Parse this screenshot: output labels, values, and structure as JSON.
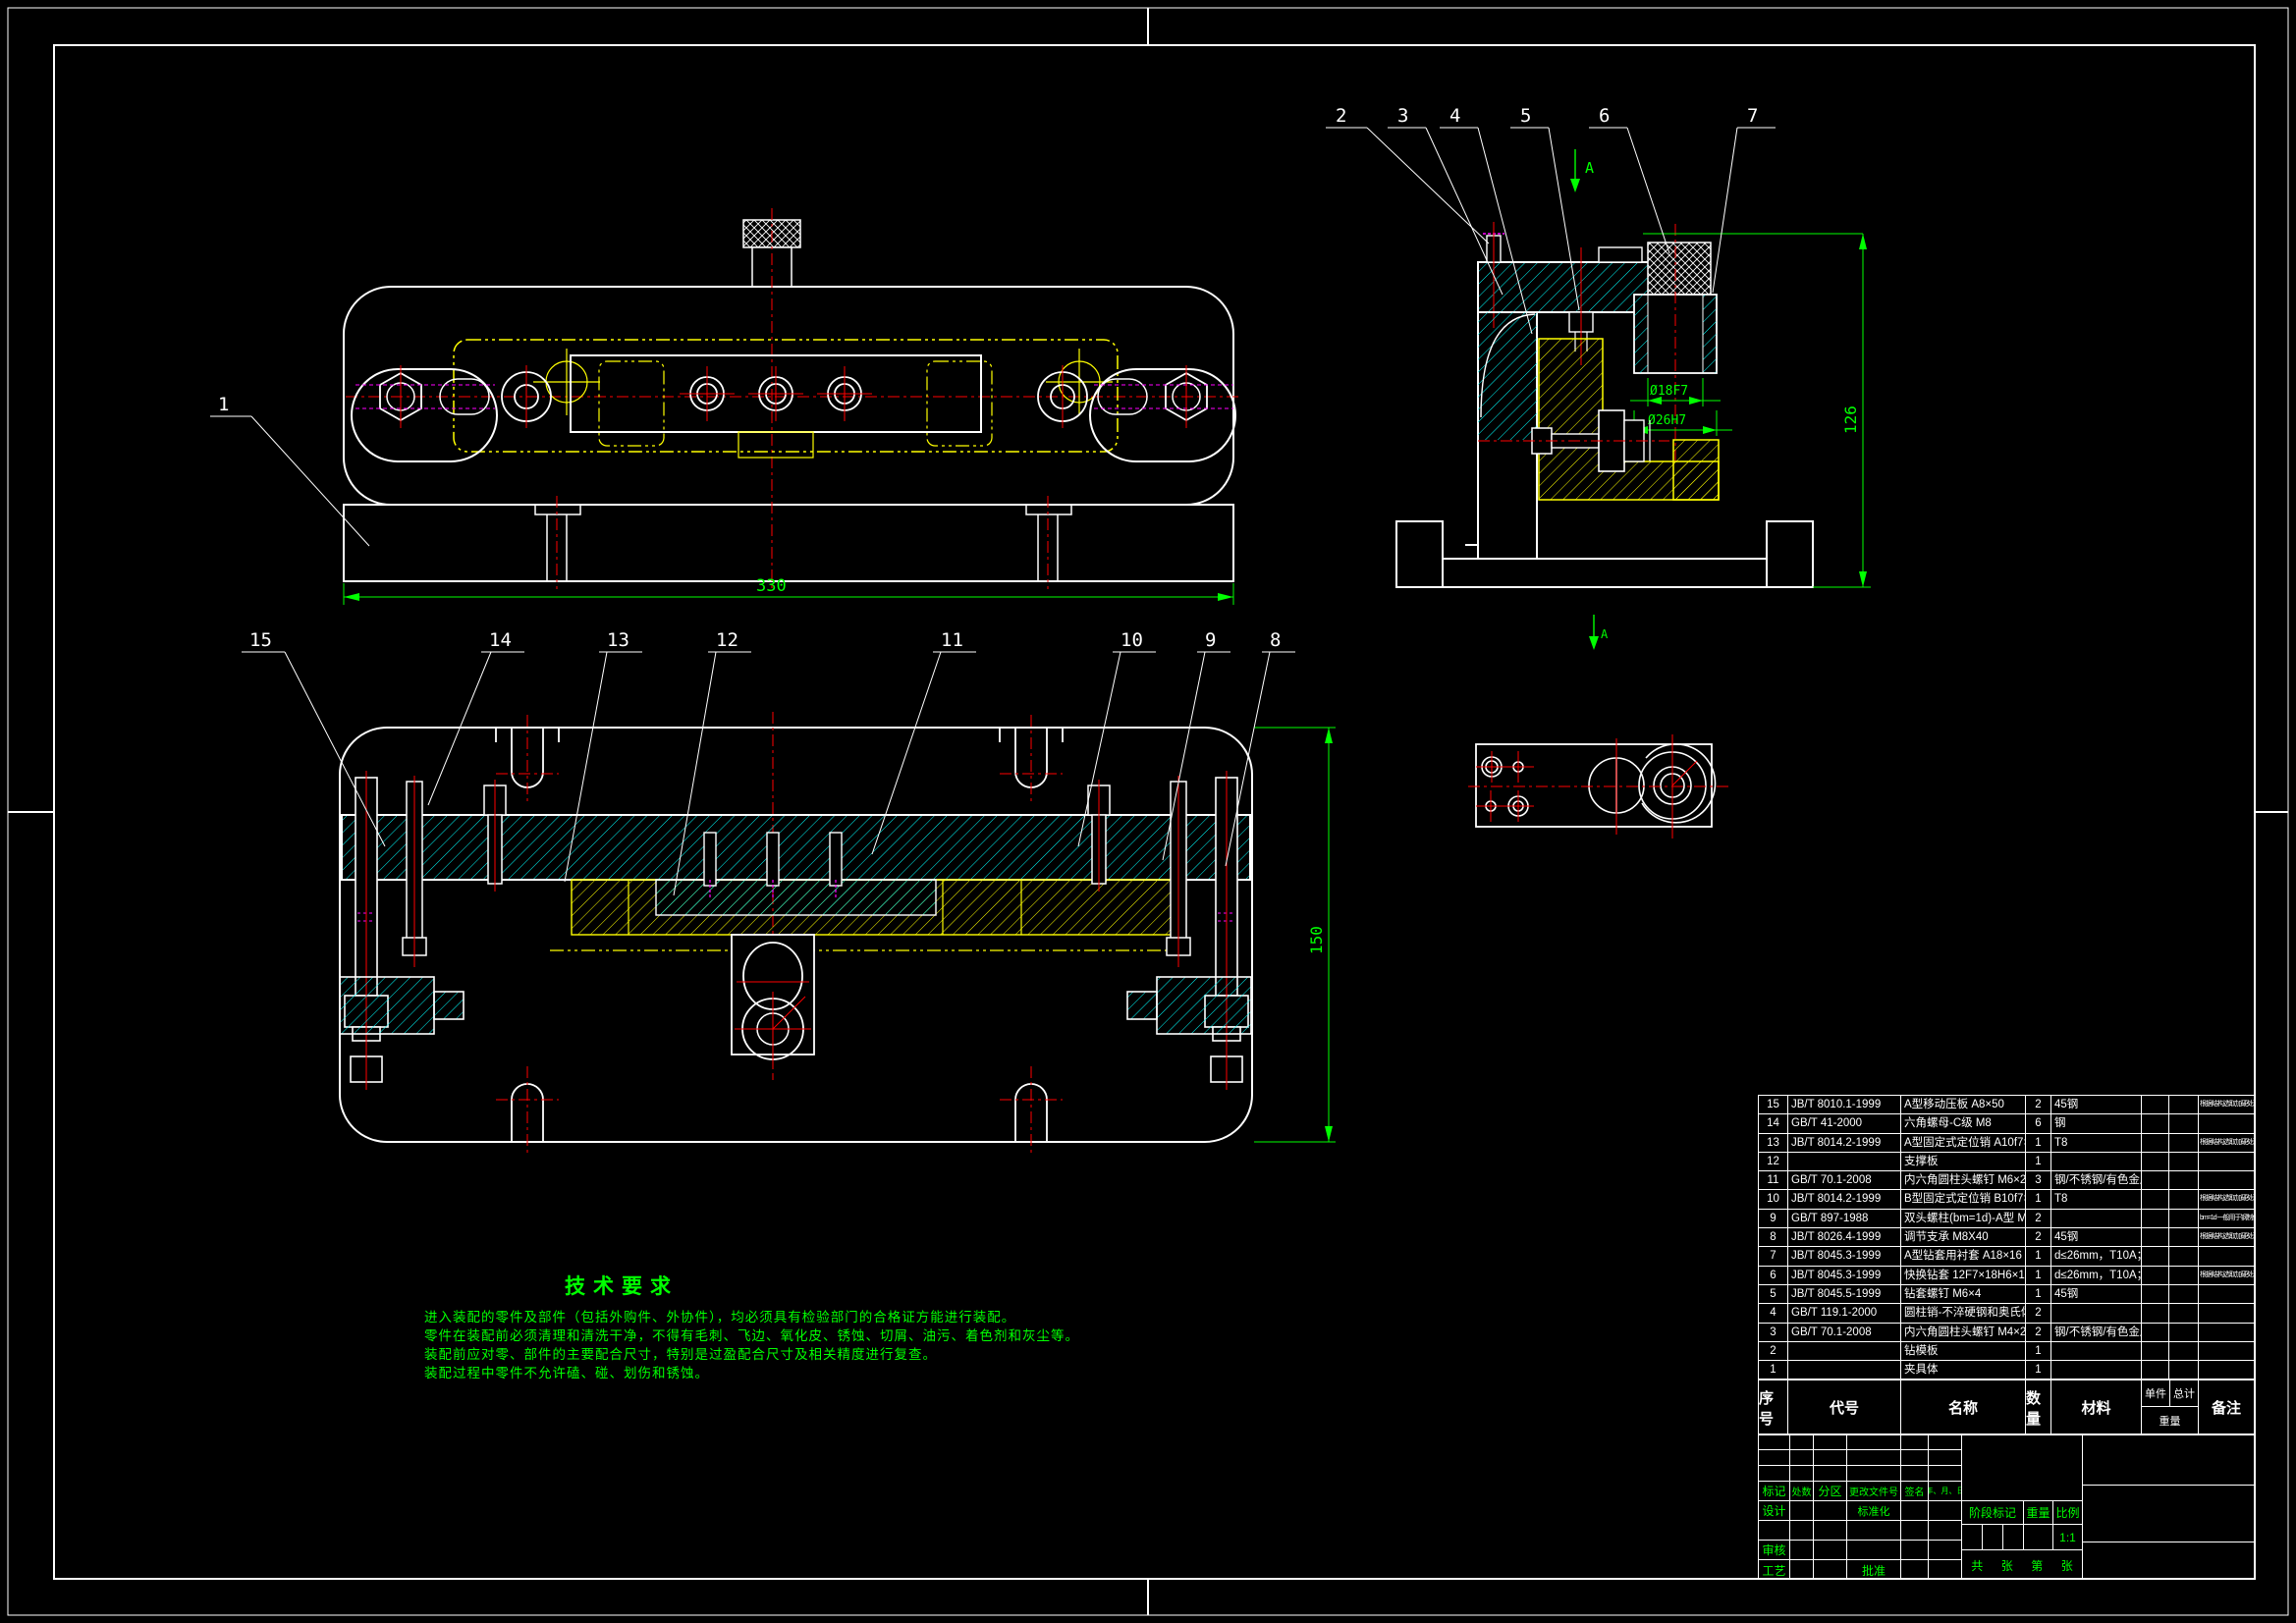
{
  "colors": {
    "background": "#000000",
    "outline": "#FFFFFF",
    "dimension": "#00FF00",
    "centerline": "#FF0000",
    "hatch": "#00FFFF",
    "phantom": "#FFFF00",
    "hidden": "#FF00FF"
  },
  "callouts": {
    "view1": [
      "1"
    ],
    "view3": [
      "2",
      "3",
      "4",
      "5",
      "6",
      "7"
    ],
    "view2": [
      "15",
      "14",
      "13",
      "12",
      "11",
      "10",
      "9",
      "8"
    ]
  },
  "dims": {
    "view1_width": "330",
    "view2_height": "150",
    "view3_height": "126",
    "fit_inner": "Ø18F7",
    "fit_outer": "Ø26H7",
    "section_label_top": "A",
    "section_label_bottom": "A"
  },
  "tech": {
    "title": "技术要求",
    "lines": [
      "进入装配的零件及部件（包括外购件、外协件），均必须具有检验部门的合格证方能进行装配。",
      "零件在装配前必须清理和清洗干净，不得有毛刺、飞边、氧化皮、锈蚀、切屑、油污、着色剂和灰尘等。",
      "装配前应对零、部件的主要配合尺寸，特别是过盈配合尺寸及相关精度进行复查。",
      "装配过程中零件不允许磕、碰、划伤和锈蚀。"
    ]
  },
  "bom": {
    "headers": {
      "no": "序号",
      "code": "代号",
      "name": "名称",
      "qty": "数量",
      "material": "材料",
      "unit": "单件",
      "total": "总计",
      "weight": "重量",
      "remark": "备注"
    },
    "rows": [
      {
        "no": "15",
        "code": "JB/T 8010.1-1999",
        "name": "A型移动压板 A8×50",
        "qty": "2",
        "material": "45钢",
        "unit": "",
        "total": "",
        "remark": "根据结构选取加硬处理"
      },
      {
        "no": "14",
        "code": "GB/T 41-2000",
        "name": "六角螺母-C级 M8",
        "qty": "6",
        "material": "钢",
        "unit": "",
        "total": "",
        "remark": ""
      },
      {
        "no": "13",
        "code": "JB/T 8014.2-1999",
        "name": "A型固定式定位销 A10f7×14",
        "qty": "1",
        "material": "T8",
        "unit": "",
        "total": "",
        "remark": "根据结构选取加硬处理"
      },
      {
        "no": "12",
        "code": "",
        "name": "支撑板",
        "qty": "1",
        "material": "",
        "unit": "",
        "total": "",
        "remark": ""
      },
      {
        "no": "11",
        "code": "GB/T 70.1-2008",
        "name": "内六角圆柱头螺钉 M6×20",
        "qty": "3",
        "material": "钢/不锈钢/有色金属",
        "unit": "",
        "total": "",
        "remark": ""
      },
      {
        "no": "10",
        "code": "JB/T 8014.2-1999",
        "name": "B型固定式定位销 B10f7×14",
        "qty": "1",
        "material": "T8",
        "unit": "",
        "total": "",
        "remark": "根据结构选取加硬处理"
      },
      {
        "no": "9",
        "code": "GB/T 897-1988",
        "name": "双头螺柱(bm=1d)-A型 M8×50",
        "qty": "2",
        "material": "",
        "unit": "",
        "total": "",
        "remark": "bm=1d 一般用于钢制件"
      },
      {
        "no": "8",
        "code": "JB/T 8026.4-1999",
        "name": "调节支承 M8X40",
        "qty": "2",
        "material": "45钢",
        "unit": "",
        "total": "",
        "remark": "根据结构选取加硬处理"
      },
      {
        "no": "7",
        "code": "JB/T 8045.3-1999",
        "name": "A型钻套用衬套 A18×16",
        "qty": "1",
        "material": "d≤26mm，T10A；d>26mm，20钢",
        "unit": "",
        "total": "",
        "remark": ""
      },
      {
        "no": "6",
        "code": "JB/T 8045.3-1999",
        "name": "快换钻套 12F7×18H6×14或12F7×18h6×16",
        "qty": "1",
        "material": "d≤26mm，T10A；d>26mm，20钢",
        "unit": "",
        "total": "",
        "remark": "根据结构选取加硬处理"
      },
      {
        "no": "5",
        "code": "JB/T 8045.5-1999",
        "name": "钻套螺钉 M6×4",
        "qty": "1",
        "material": "45钢",
        "unit": "",
        "total": "",
        "remark": ""
      },
      {
        "no": "4",
        "code": "GB/T 119.1-2000",
        "name": "圆柱销-不淬硬钢和奥氏体不锈钢 4×25",
        "qty": "2",
        "material": "",
        "unit": "",
        "total": "",
        "remark": ""
      },
      {
        "no": "3",
        "code": "GB/T 70.1-2008",
        "name": "内六角圆柱头螺钉 M4×20",
        "qty": "2",
        "material": "钢/不锈钢/有色金属",
        "unit": "",
        "total": "",
        "remark": ""
      },
      {
        "no": "2",
        "code": "",
        "name": "钻模板",
        "qty": "1",
        "material": "",
        "unit": "",
        "total": "",
        "remark": ""
      },
      {
        "no": "1",
        "code": "",
        "name": "夹具体",
        "qty": "1",
        "material": "",
        "unit": "",
        "total": "",
        "remark": ""
      }
    ]
  },
  "title_block": {
    "labels": {
      "biaoji": "标记",
      "chushu": "处数",
      "fenqu": "分区",
      "genggai": "更改文件号",
      "qianming": "签名",
      "nianyueri": "年、月、日",
      "sheji": "设计",
      "biaozhunhua": "标准化",
      "shenhe": "审核",
      "gongyi": "工艺",
      "pizhun": "批准",
      "jieduan": "阶段标记",
      "zhongliang": "重量",
      "bili": "比例",
      "gong": "共",
      "zhang1": "张",
      "di": "第",
      "zhang2": "张"
    },
    "values": {
      "scale": "1:1"
    }
  }
}
